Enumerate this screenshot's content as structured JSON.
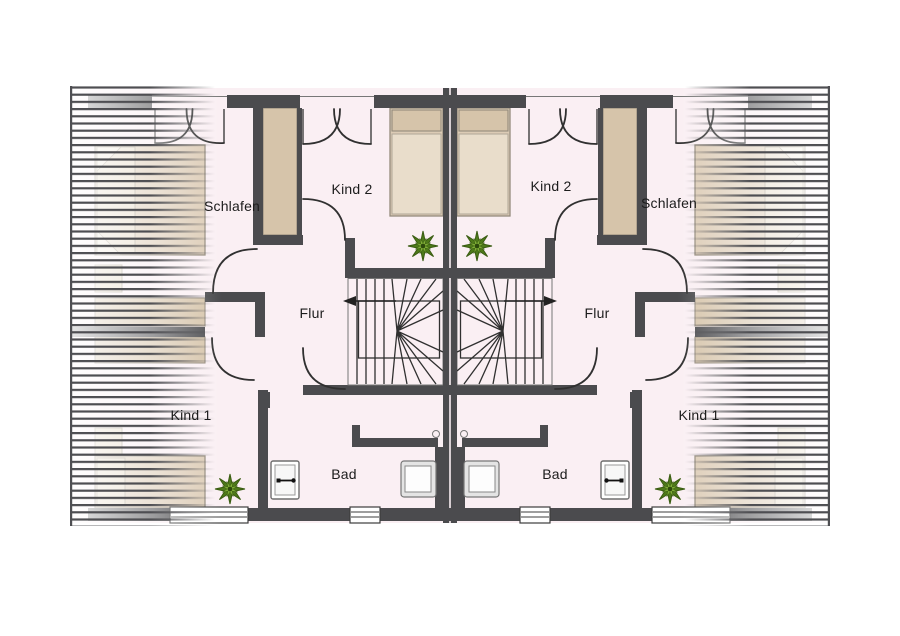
{
  "document": {
    "kind": "architectural-floor-plan",
    "description": "Upper floor plan of a mirrored semi-detached house (two identical units), German room labels"
  },
  "labels": {
    "schlafen": "Schlafen",
    "kind2": "Kind 2",
    "flur": "Flur",
    "kind1": "Kind 1",
    "bad": "Bad"
  },
  "units": [
    {
      "side": "left",
      "rooms": [
        "Schlafen",
        "Kind 2",
        "Flur",
        "Kind 1",
        "Bad"
      ]
    },
    {
      "side": "right",
      "rooms": [
        "Schlafen",
        "Kind 2",
        "Flur",
        "Kind 1",
        "Bad"
      ]
    }
  ],
  "icons": [
    "plant-icon",
    "stair-direction-arrow-icon",
    "washbasin-icon",
    "toilet-icon",
    "shower-drain-icon",
    "window-swing-icon",
    "door-swing-icon",
    "roof-slope-hatch"
  ],
  "colors": {
    "wall": "#4b4b4e",
    "floor": "#faeff3",
    "furniture": "#dccbb5",
    "furniture_light": "#e7dbc8",
    "furniture_dark": "#d6c4aa",
    "line": "#303030",
    "plant": "#4e7a1a",
    "plant_light": "#7fae36"
  }
}
